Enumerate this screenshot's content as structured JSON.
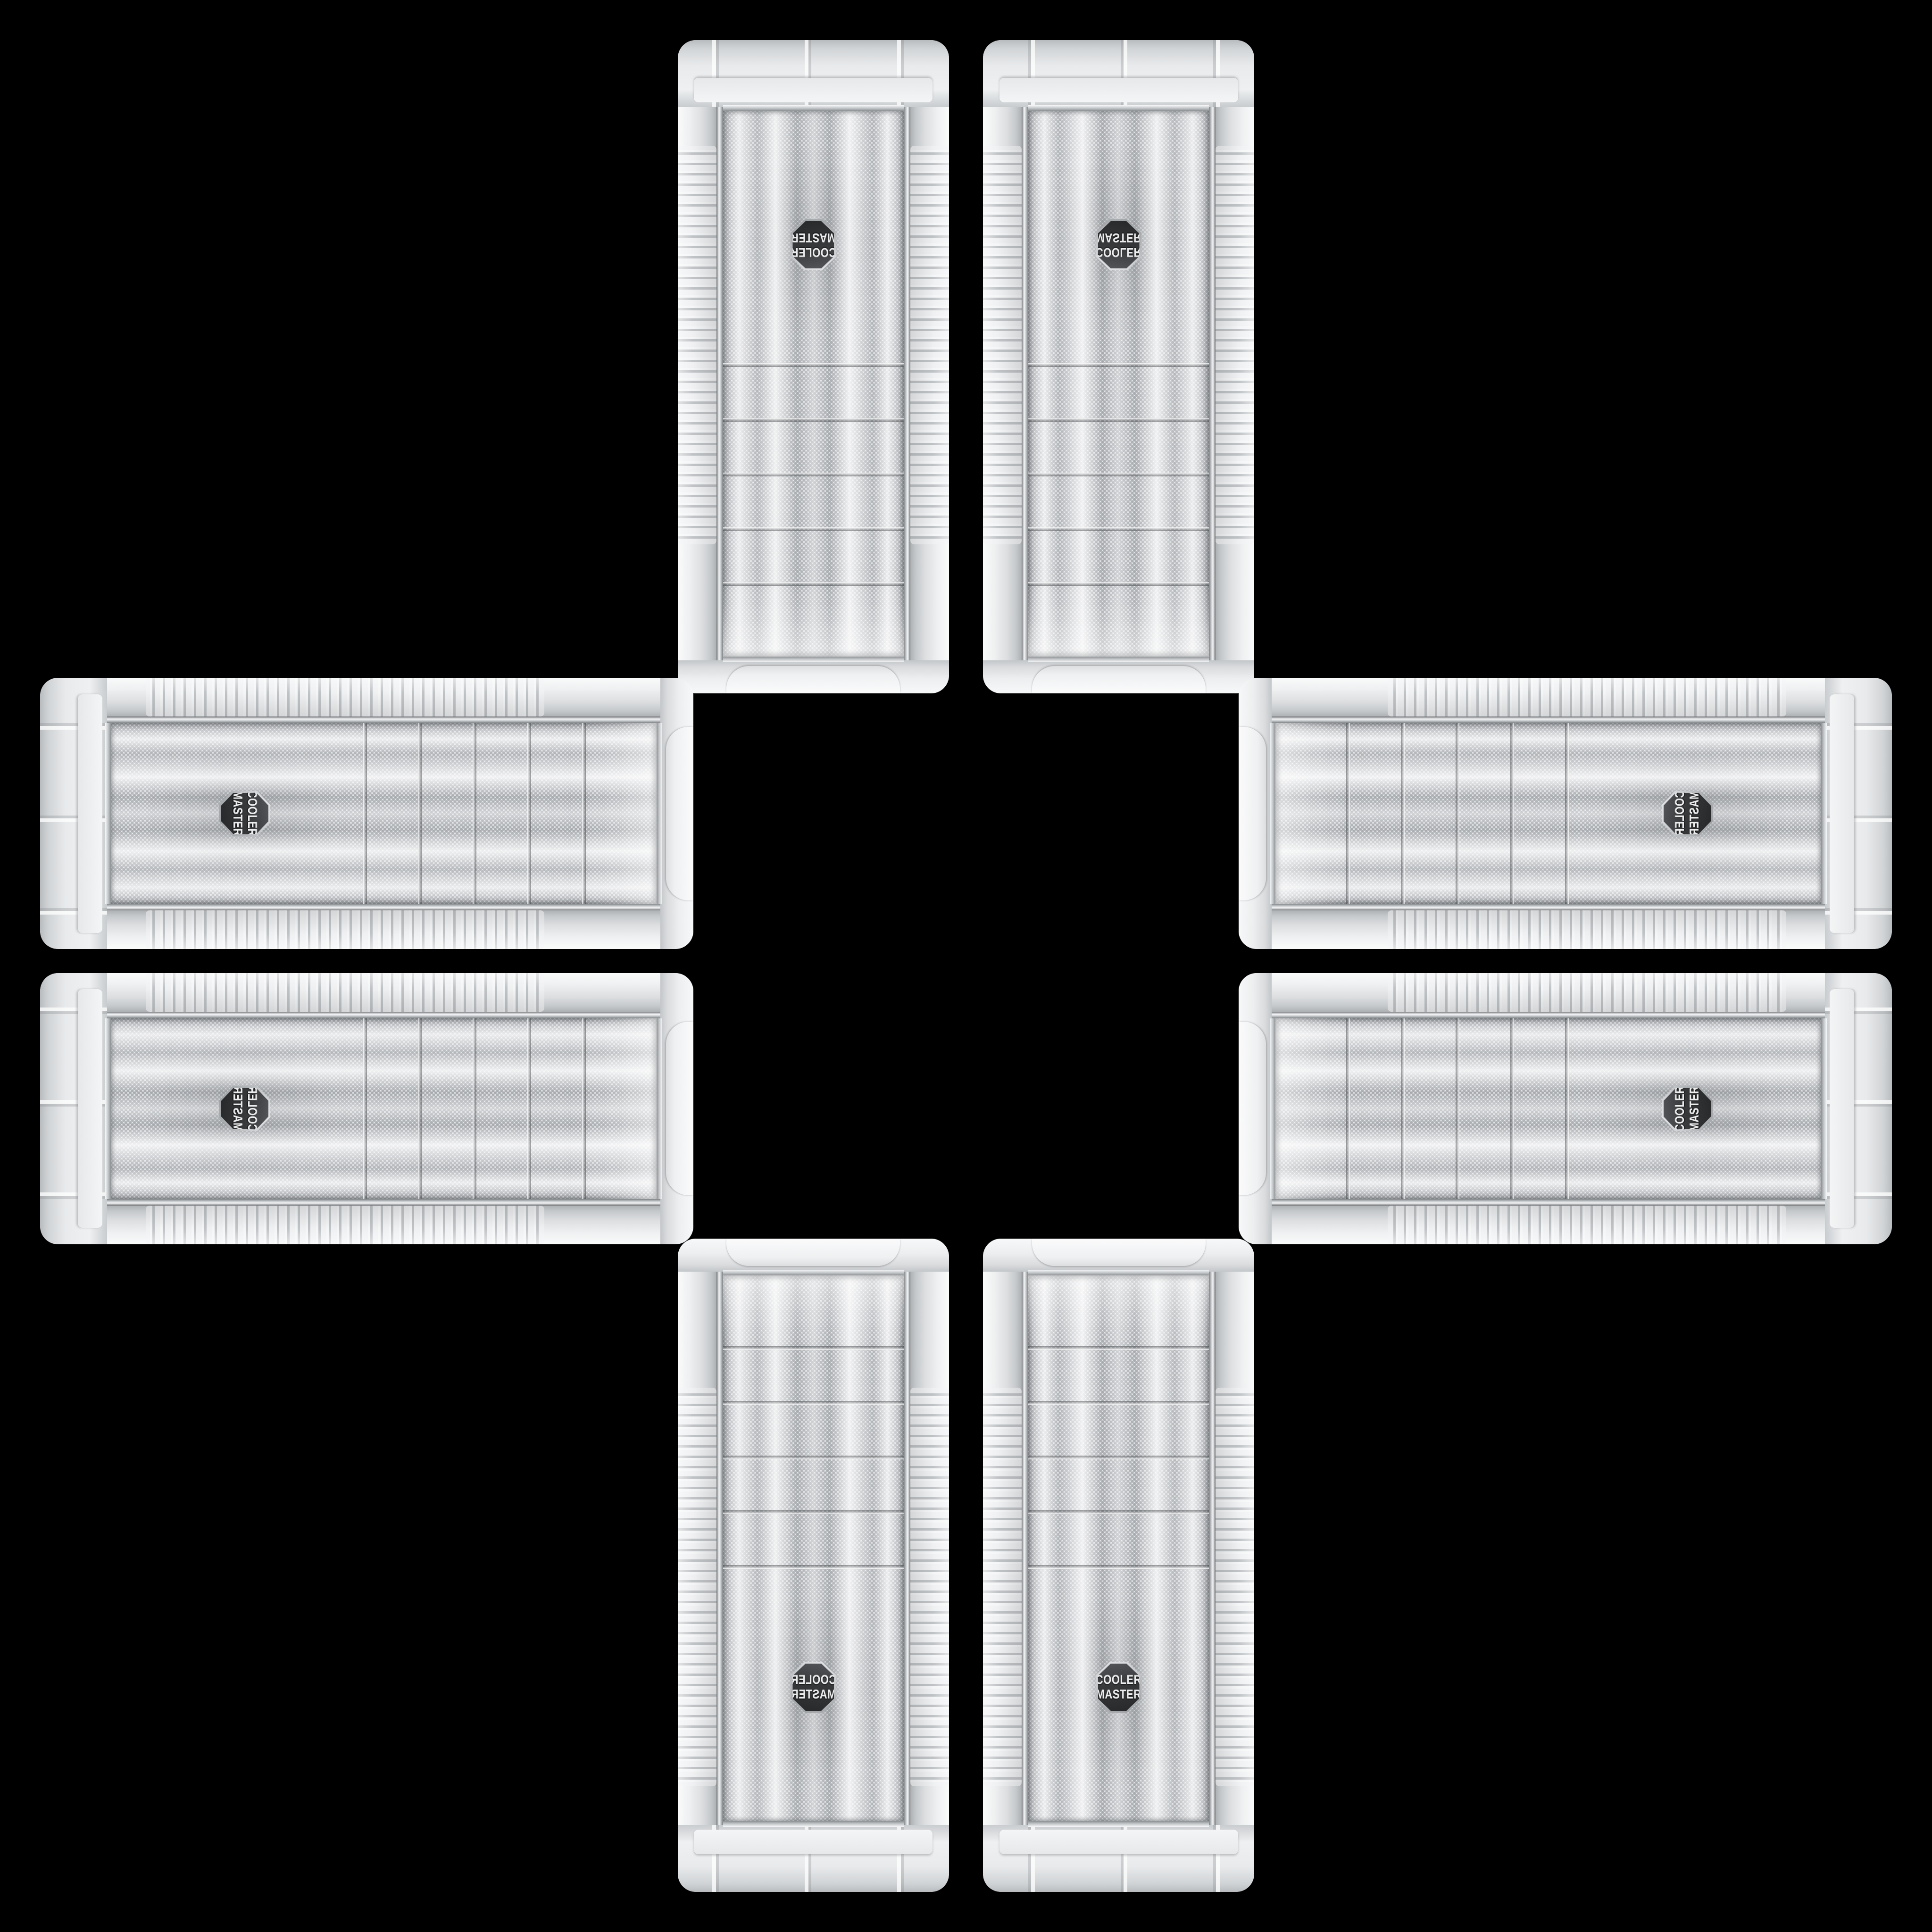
{
  "scene": {
    "background_color": "#000000",
    "arrangement": "eight white PC-case mesh front panels arranged in a plus cross on black",
    "case_count": 8
  },
  "case": {
    "brand": "Cooler Master",
    "body_color": "#e8eaec",
    "mesh_color": "#e3e5e7",
    "mesh_dot_color": "#a6a9ad",
    "chrome_color": "#c2c5c8",
    "bay_slat_count": 5,
    "badge": {
      "shape": "hexagon",
      "background_color": "#37393b",
      "text_color": "#ededee",
      "line1": "COOLER",
      "line2": "MASTER"
    }
  },
  "cases": [
    {
      "id": "top-left",
      "arm": "top",
      "orientation": "rotated-180"
    },
    {
      "id": "top-right",
      "arm": "top",
      "orientation": "flipped-vertical"
    },
    {
      "id": "left-top",
      "arm": "left",
      "orientation": "rotated-90-cw"
    },
    {
      "id": "right-top",
      "arm": "right",
      "orientation": "rotated-90-ccw-flipped"
    },
    {
      "id": "left-bottom",
      "arm": "left",
      "orientation": "rotated-90-cw-flipped"
    },
    {
      "id": "right-bottom",
      "arm": "right",
      "orientation": "rotated-90-ccw"
    },
    {
      "id": "bottom-left",
      "arm": "bottom",
      "orientation": "flipped-horizontal"
    },
    {
      "id": "bottom-right",
      "arm": "bottom",
      "orientation": "upright"
    }
  ]
}
